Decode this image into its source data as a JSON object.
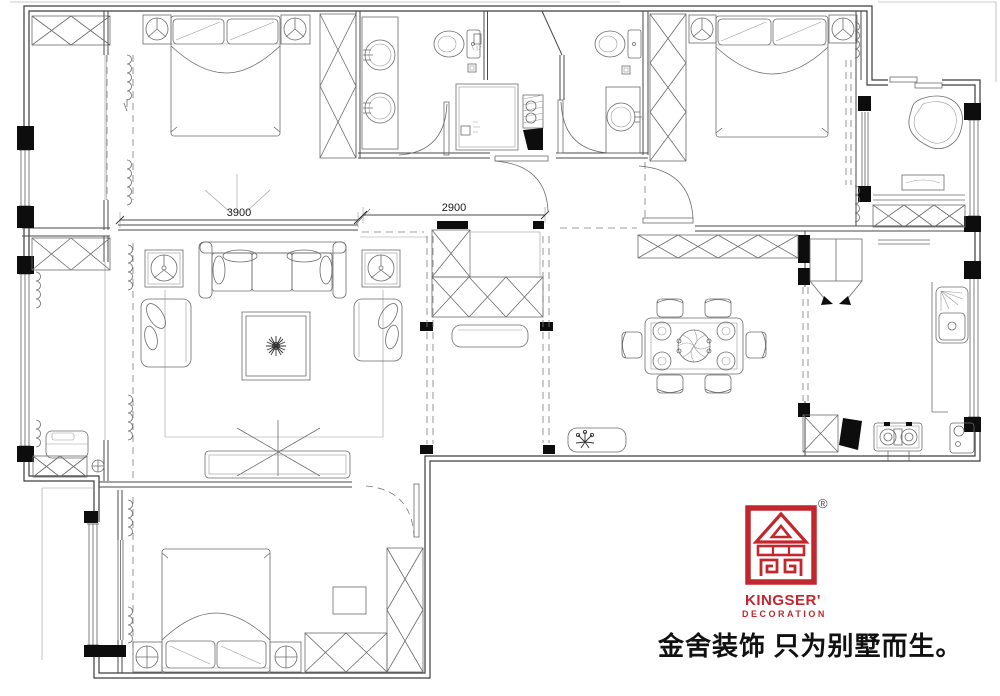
{
  "dimensions": {
    "bedroom_width": "3900",
    "hall_width": "2900"
  },
  "branding": {
    "registered_mark": "®",
    "logo_name": "KINGSER'",
    "logo_subtitle": "DECORATION",
    "tagline": "金舍装饰 只为别墅而生。",
    "brand_red": "#c1272d"
  },
  "drawing": {
    "wall_color": "#3d3d3d",
    "furniture_color": "#6b6b6b",
    "column_fill": "#0d0d0d",
    "background": "#ffffff"
  }
}
